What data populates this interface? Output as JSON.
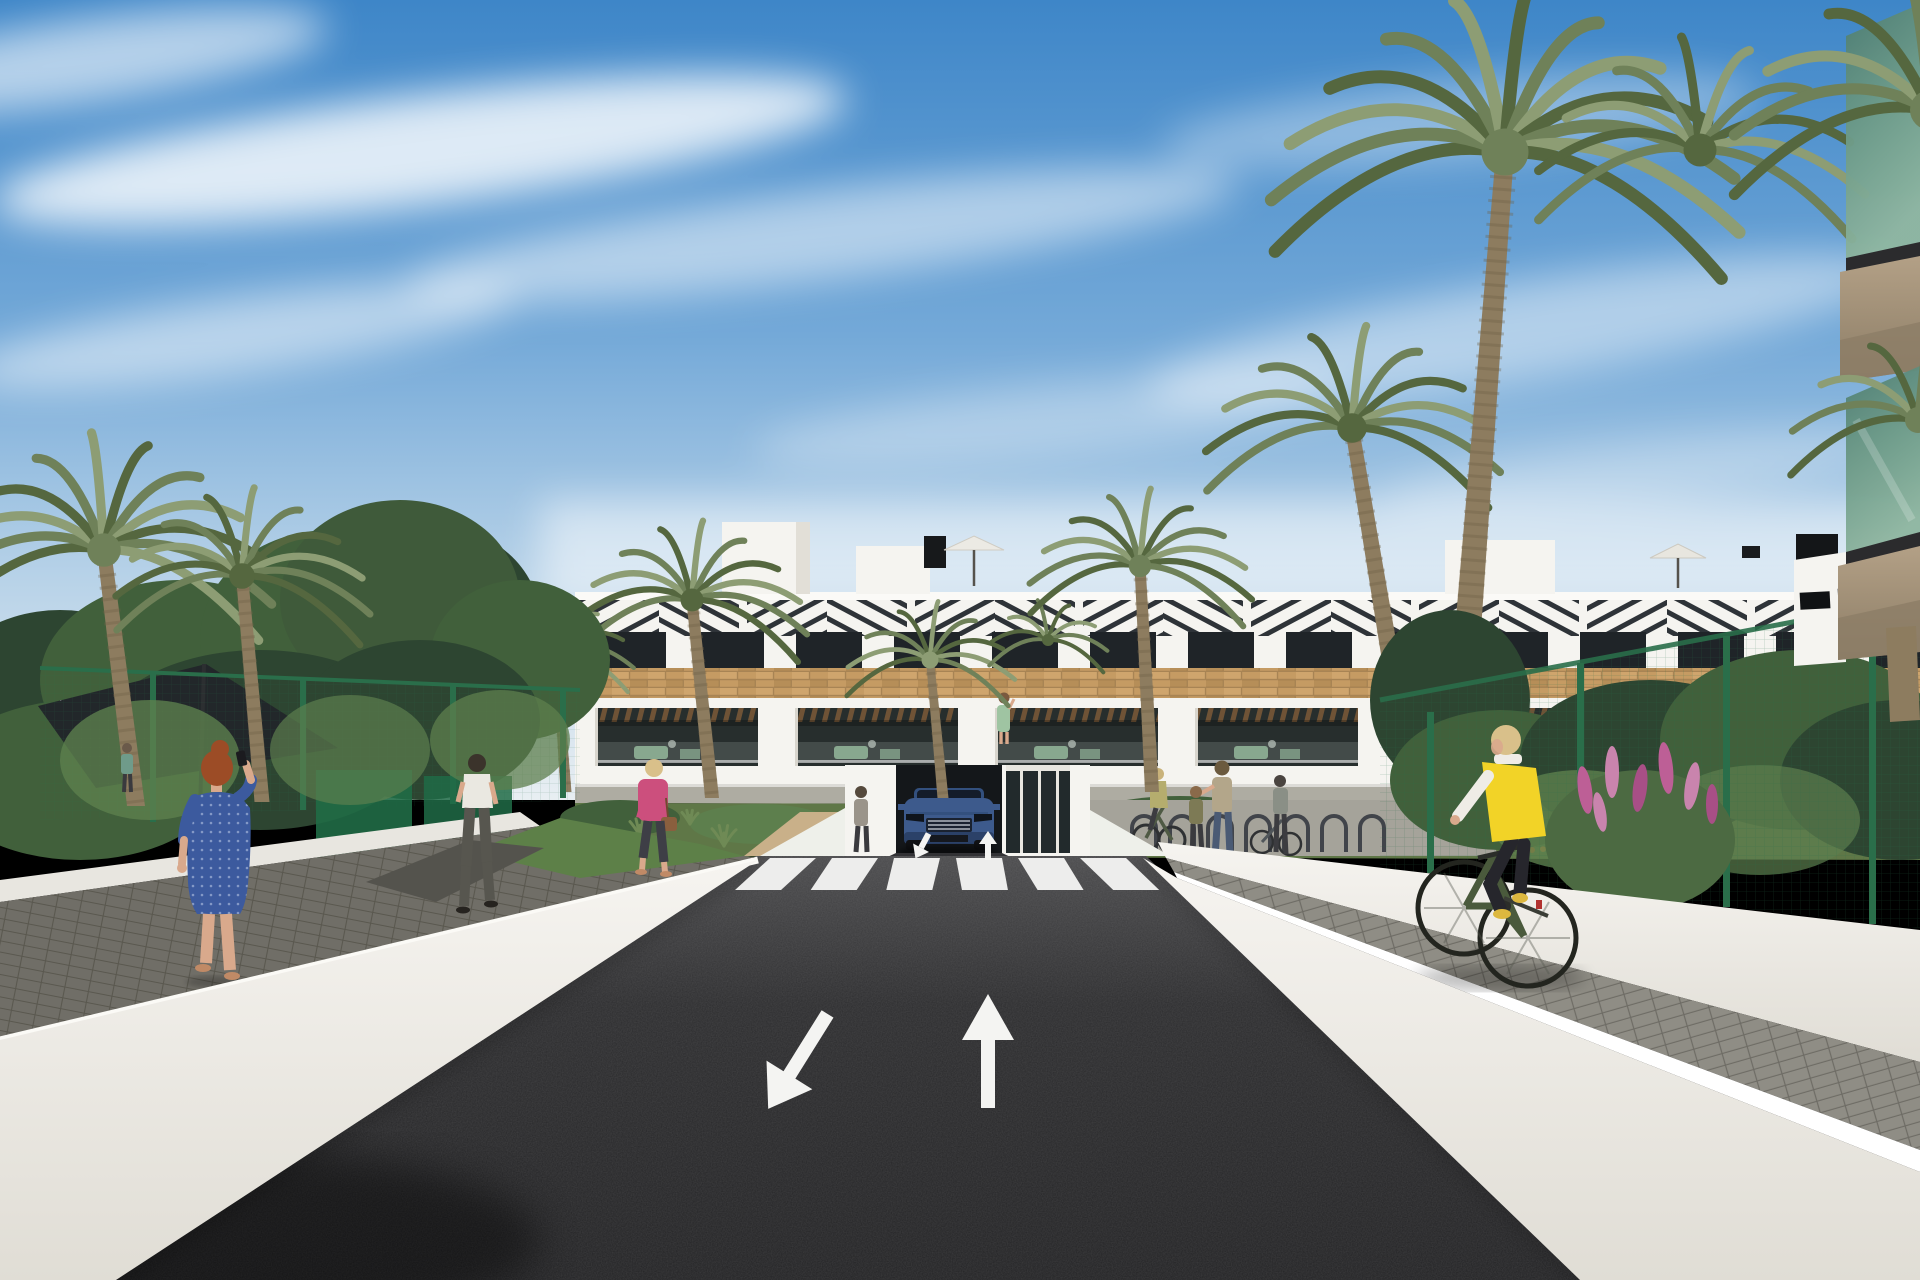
{
  "scene": {
    "title": "3D architectural render: new-build white apartment complex with palm trees, two-way access road, crosswalk, pedestrians and cyclist",
    "type": "architectural-visualization",
    "time_of_day": "sunny day",
    "sky": "blue sky with wispy white cloud streaks"
  },
  "palette": {
    "sky-top": "#3e86c8",
    "sky-mid": "#74a9d8",
    "sky-low": "#b7d2e8",
    "sky-horizon": "#e8eef2",
    "cloud": "#ffffff",
    "bldg-white": "#f5f4f0",
    "bldg-shade": "#ddd9d0",
    "slat": "#2e3338",
    "win": "#1f2428",
    "brick": "#c59b63",
    "brick-hi": "#d6ad74",
    "brick-lo": "#a8824e",
    "pergola": "#6f5336",
    "glass": "#272e2d",
    "furn": "#85ac8c",
    "slab": "#b3a086",
    "slab-dark": "#8c7d66",
    "palm1": "#6f8159",
    "palm2": "#55673f",
    "palm3": "#8d9d74",
    "trunk": "#8d7c5f",
    "trunk-dark": "#6f6049",
    "veg1": "#2d4531",
    "veg2": "#41603b",
    "veg3": "#5d7f4e",
    "grass": "#5d8048",
    "fl-orange": "#d06f2c",
    "fl-pink": "#bd5f96",
    "fence": "#2a6e4a",
    "sail": "#22272a",
    "wall": "#f1efeb",
    "wall-shade": "#d9d6cf",
    "curb": "#ffffff",
    "paver": "#706e67",
    "paver-gap": "#5a584f",
    "sidewalk": "#8f8d85",
    "sidewalk-gap": "#6e6c65",
    "asphalt": "#28282a",
    "mark": "#f4f4f2",
    "car": "#3d5a8c",
    "car-dark": "#1d2533",
    "chrome": "#a7afb8",
    "skin": "#d9a98c",
    "skin-dark": "#c08a66",
    "hair-red": "#9c4c26",
    "dress-blue": "#3c5a9e",
    "shirt-white": "#eae8e1",
    "pants-gray": "#57564f",
    "pink": "#cc4f7d",
    "blonde": "#d9c08a",
    "vest": "#f2d327",
    "black-leg": "#26262c",
    "bike": "#4a5a3c",
    "shoe-yel": "#ddb83f",
    "jeans": "#4a5a74"
  },
  "road": {
    "surface": "dark asphalt",
    "crosswalk": {
      "stripe_count": 6
    },
    "lane_arrows": [
      {
        "id": "arrow-toward-viewer",
        "direction": "down-left"
      },
      {
        "id": "arrow-away",
        "direction": "up"
      }
    ]
  },
  "inventory": {
    "people": [
      {
        "id": "woman-on-phone",
        "description": "red-haired woman in blue dotted dress on the phone",
        "position": "left walkway"
      },
      {
        "id": "man-white-tshirt",
        "description": "man in white t-shirt walking away",
        "position": "left path"
      },
      {
        "id": "woman-pink-jacket",
        "description": "blonde woman in pink jacket with brown handbag",
        "position": "center-left path"
      },
      {
        "id": "mother-and-child",
        "description": "woman with child",
        "position": "building forecourt"
      },
      {
        "id": "cyclist-at-racks",
        "description": "cyclist near bike racks",
        "position": "building forecourt"
      },
      {
        "id": "woman-pushing-bike",
        "description": "woman wheeling a bicycle",
        "position": "building forecourt"
      },
      {
        "id": "person-by-garage",
        "description": "person standing beside garage ramp",
        "position": "entrance"
      },
      {
        "id": "woman-on-balcony",
        "description": "woman in green dress on terrace",
        "position": "first floor terrace"
      },
      {
        "id": "cyclist-yellow-vest",
        "description": "blonde woman in yellow gilet on green city bike",
        "position": "right sidewalk"
      }
    ],
    "vehicles": [
      {
        "id": "blue-suv",
        "description": "blue SUV at the garage ramp"
      }
    ],
    "site_features": [
      "white apartment block with wood-look brick band and slatted pergolas",
      "roof terraces with parasols",
      "green mesh fence",
      "dark shade sail",
      "bike racks",
      "orange and pink flower beds",
      "white boundary walls",
      "paved sidewalks",
      "palm trees"
    ]
  },
  "generate": {
    "chevrons": {
      "count": 16,
      "x0": 575,
      "step": 84,
      "y": 600,
      "h": 36
    },
    "windows": {
      "count": 14,
      "x0": 600,
      "step": 98,
      "y": 632,
      "w": 66,
      "h": 36
    },
    "porches": {
      "xs": [
        578,
        778,
        978,
        1178,
        1378,
        1578,
        1778
      ]
    },
    "racks": {
      "count": 7,
      "x0": 1132,
      "step": 38,
      "base": 852,
      "h": 24,
      "r": 12
    },
    "tufts": [
      [
        640,
        836,
        10
      ],
      [
        724,
        846,
        12
      ],
      [
        980,
        842,
        11
      ],
      [
        1210,
        818,
        9
      ],
      [
        1452,
        830,
        12
      ],
      [
        1500,
        846,
        10
      ],
      [
        690,
        824,
        8
      ],
      [
        1556,
        838,
        9
      ]
    ],
    "flowers": [
      [
        560,
        850
      ],
      [
        600,
        842
      ],
      [
        648,
        852
      ],
      [
        1476,
        836
      ],
      [
        1534,
        844
      ],
      [
        1370,
        820
      ]
    ],
    "palms": [
      {
        "layer": "palms-left",
        "cx": 104,
        "cy": 550,
        "r": 168,
        "fronds": 12,
        "tones": [
          "#55673f",
          "#6f8159",
          "#8d9d74"
        ],
        "trunk": {
          "x": 136,
          "y": 806,
          "w1": 14,
          "w2": 18
        }
      },
      {
        "layer": "palms-left",
        "cx": 242,
        "cy": 576,
        "r": 128,
        "fronds": 11,
        "tones": [
          "#6f8159",
          "#55673f",
          "#8d9d74"
        ],
        "trunk": {
          "x": 262,
          "y": 802,
          "w1": 12,
          "w2": 15
        }
      },
      {
        "layer": "palms-front",
        "cx": 556,
        "cy": 650,
        "r": 78,
        "fronds": 9,
        "tones": [
          "#55673f",
          "#6f8159",
          "#8d9d74"
        ],
        "trunk": {
          "x": 566,
          "y": 792,
          "w1": 8,
          "w2": 11
        }
      },
      {
        "layer": "palms-front",
        "cx": 692,
        "cy": 600,
        "r": 115,
        "fronds": 11,
        "tones": [
          "#6f8159",
          "#55673f",
          "#8d9d74"
        ],
        "trunk": {
          "x": 712,
          "y": 798,
          "w1": 11,
          "w2": 14
        }
      },
      {
        "layer": "palms-front",
        "cx": 930,
        "cy": 660,
        "r": 85,
        "fronds": 9,
        "tones": [
          "#55673f",
          "#8d9d74",
          "#6f8159"
        ],
        "trunk": {
          "x": 943,
          "y": 798,
          "w1": 8,
          "w2": 11
        }
      },
      {
        "layer": "palms-front",
        "cx": 1048,
        "cy": 640,
        "r": 60,
        "fronds": 8,
        "tones": [
          "#6f8159",
          "#55673f",
          "#8d9d74"
        ]
      },
      {
        "layer": "palms-front",
        "cx": 1140,
        "cy": 566,
        "r": 112,
        "fronds": 11,
        "tones": [
          "#55673f",
          "#6f8159",
          "#8d9d74"
        ],
        "trunk": {
          "x": 1152,
          "y": 792,
          "w1": 11,
          "w2": 14
        }
      },
      {
        "layer": "palms-big",
        "cx": 1352,
        "cy": 428,
        "r": 148,
        "fronds": 11,
        "tones": [
          "#6f8159",
          "#55673f",
          "#8d9d74"
        ],
        "trunk": {
          "x": 1396,
          "y": 692,
          "w1": 14,
          "w2": 18
        }
      },
      {
        "layer": "palms-big",
        "cx": 1505,
        "cy": 152,
        "r": 235,
        "fronds": 13,
        "tones": [
          "#55673f",
          "#6f8159",
          "#8d9d74"
        ],
        "trunk": {
          "x": 1468,
          "y": 630,
          "w1": 18,
          "w2": 26
        }
      },
      {
        "layer": "palms-big",
        "cx": 1700,
        "cy": 150,
        "r": 165,
        "fronds": 10,
        "tones": [
          "#6f8159",
          "#55673f",
          "#8d9d74"
        ]
      },
      {
        "layer": "palms-overlay",
        "cx": 1918,
        "cy": 420,
        "r": 130,
        "fronds": 9,
        "tones": [
          "#55673f",
          "#6f8159",
          "#8d9d74"
        ]
      },
      {
        "layer": "palms-overlay",
        "cx": 1930,
        "cy": 110,
        "r": 200,
        "fronds": 10,
        "tones": [
          "#55673f",
          "#6f8159",
          "#8d9d74"
        ]
      }
    ]
  }
}
